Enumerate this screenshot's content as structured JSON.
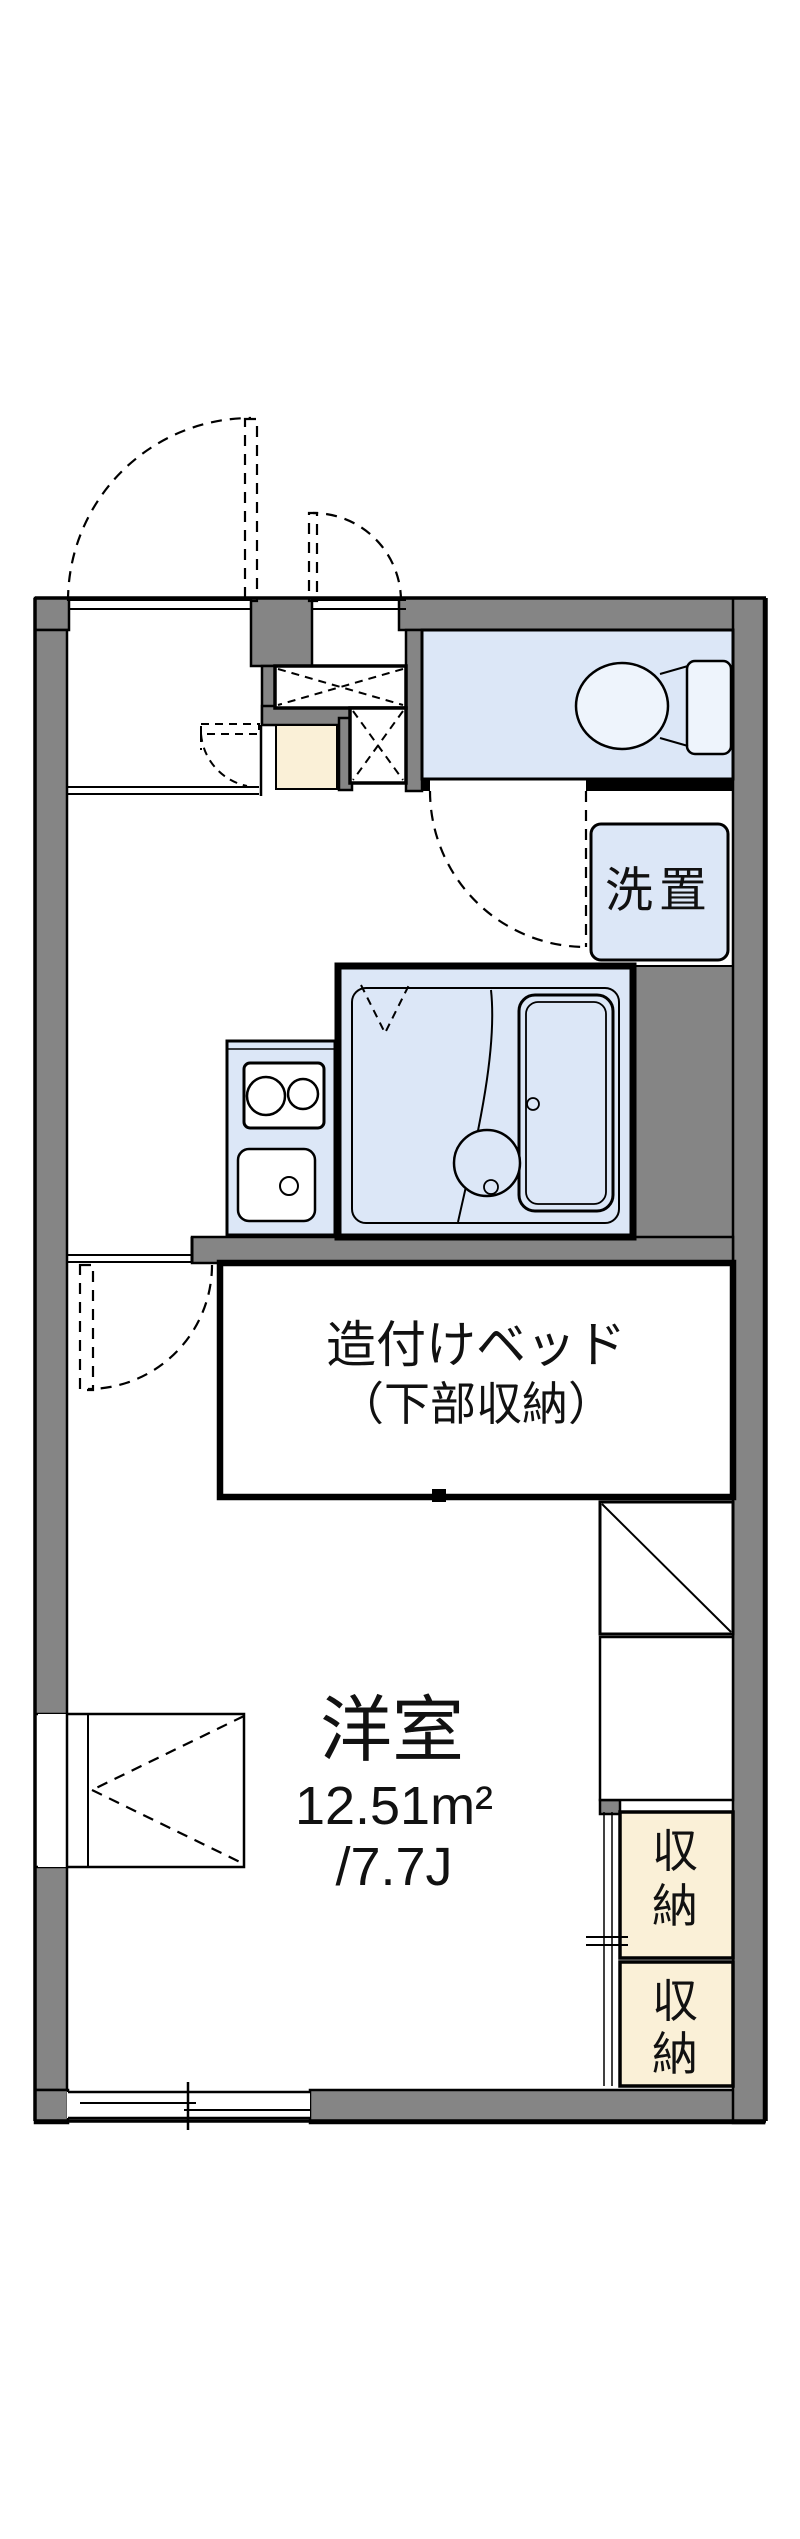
{
  "colors": {
    "wall_gray": "#858585",
    "water_blue": "#dce7f7",
    "fixture_blue": "#eef4fc",
    "genkan_tan": "#faf0d7",
    "line_black": "#000000",
    "background": "#ffffff"
  },
  "rooms": {
    "main": {
      "name": "洋室",
      "area_m2": "12.51m²",
      "area_jo": "/7.7J"
    },
    "bed": {
      "line1": "造付けベッド",
      "line2": "（下部収納）"
    },
    "washer": {
      "label": "洗置"
    },
    "storage_upper": {
      "label": "収納",
      "chars": [
        "収",
        "納"
      ]
    },
    "storage_lower": {
      "label": "収納",
      "chars": [
        "収",
        "納"
      ]
    }
  }
}
